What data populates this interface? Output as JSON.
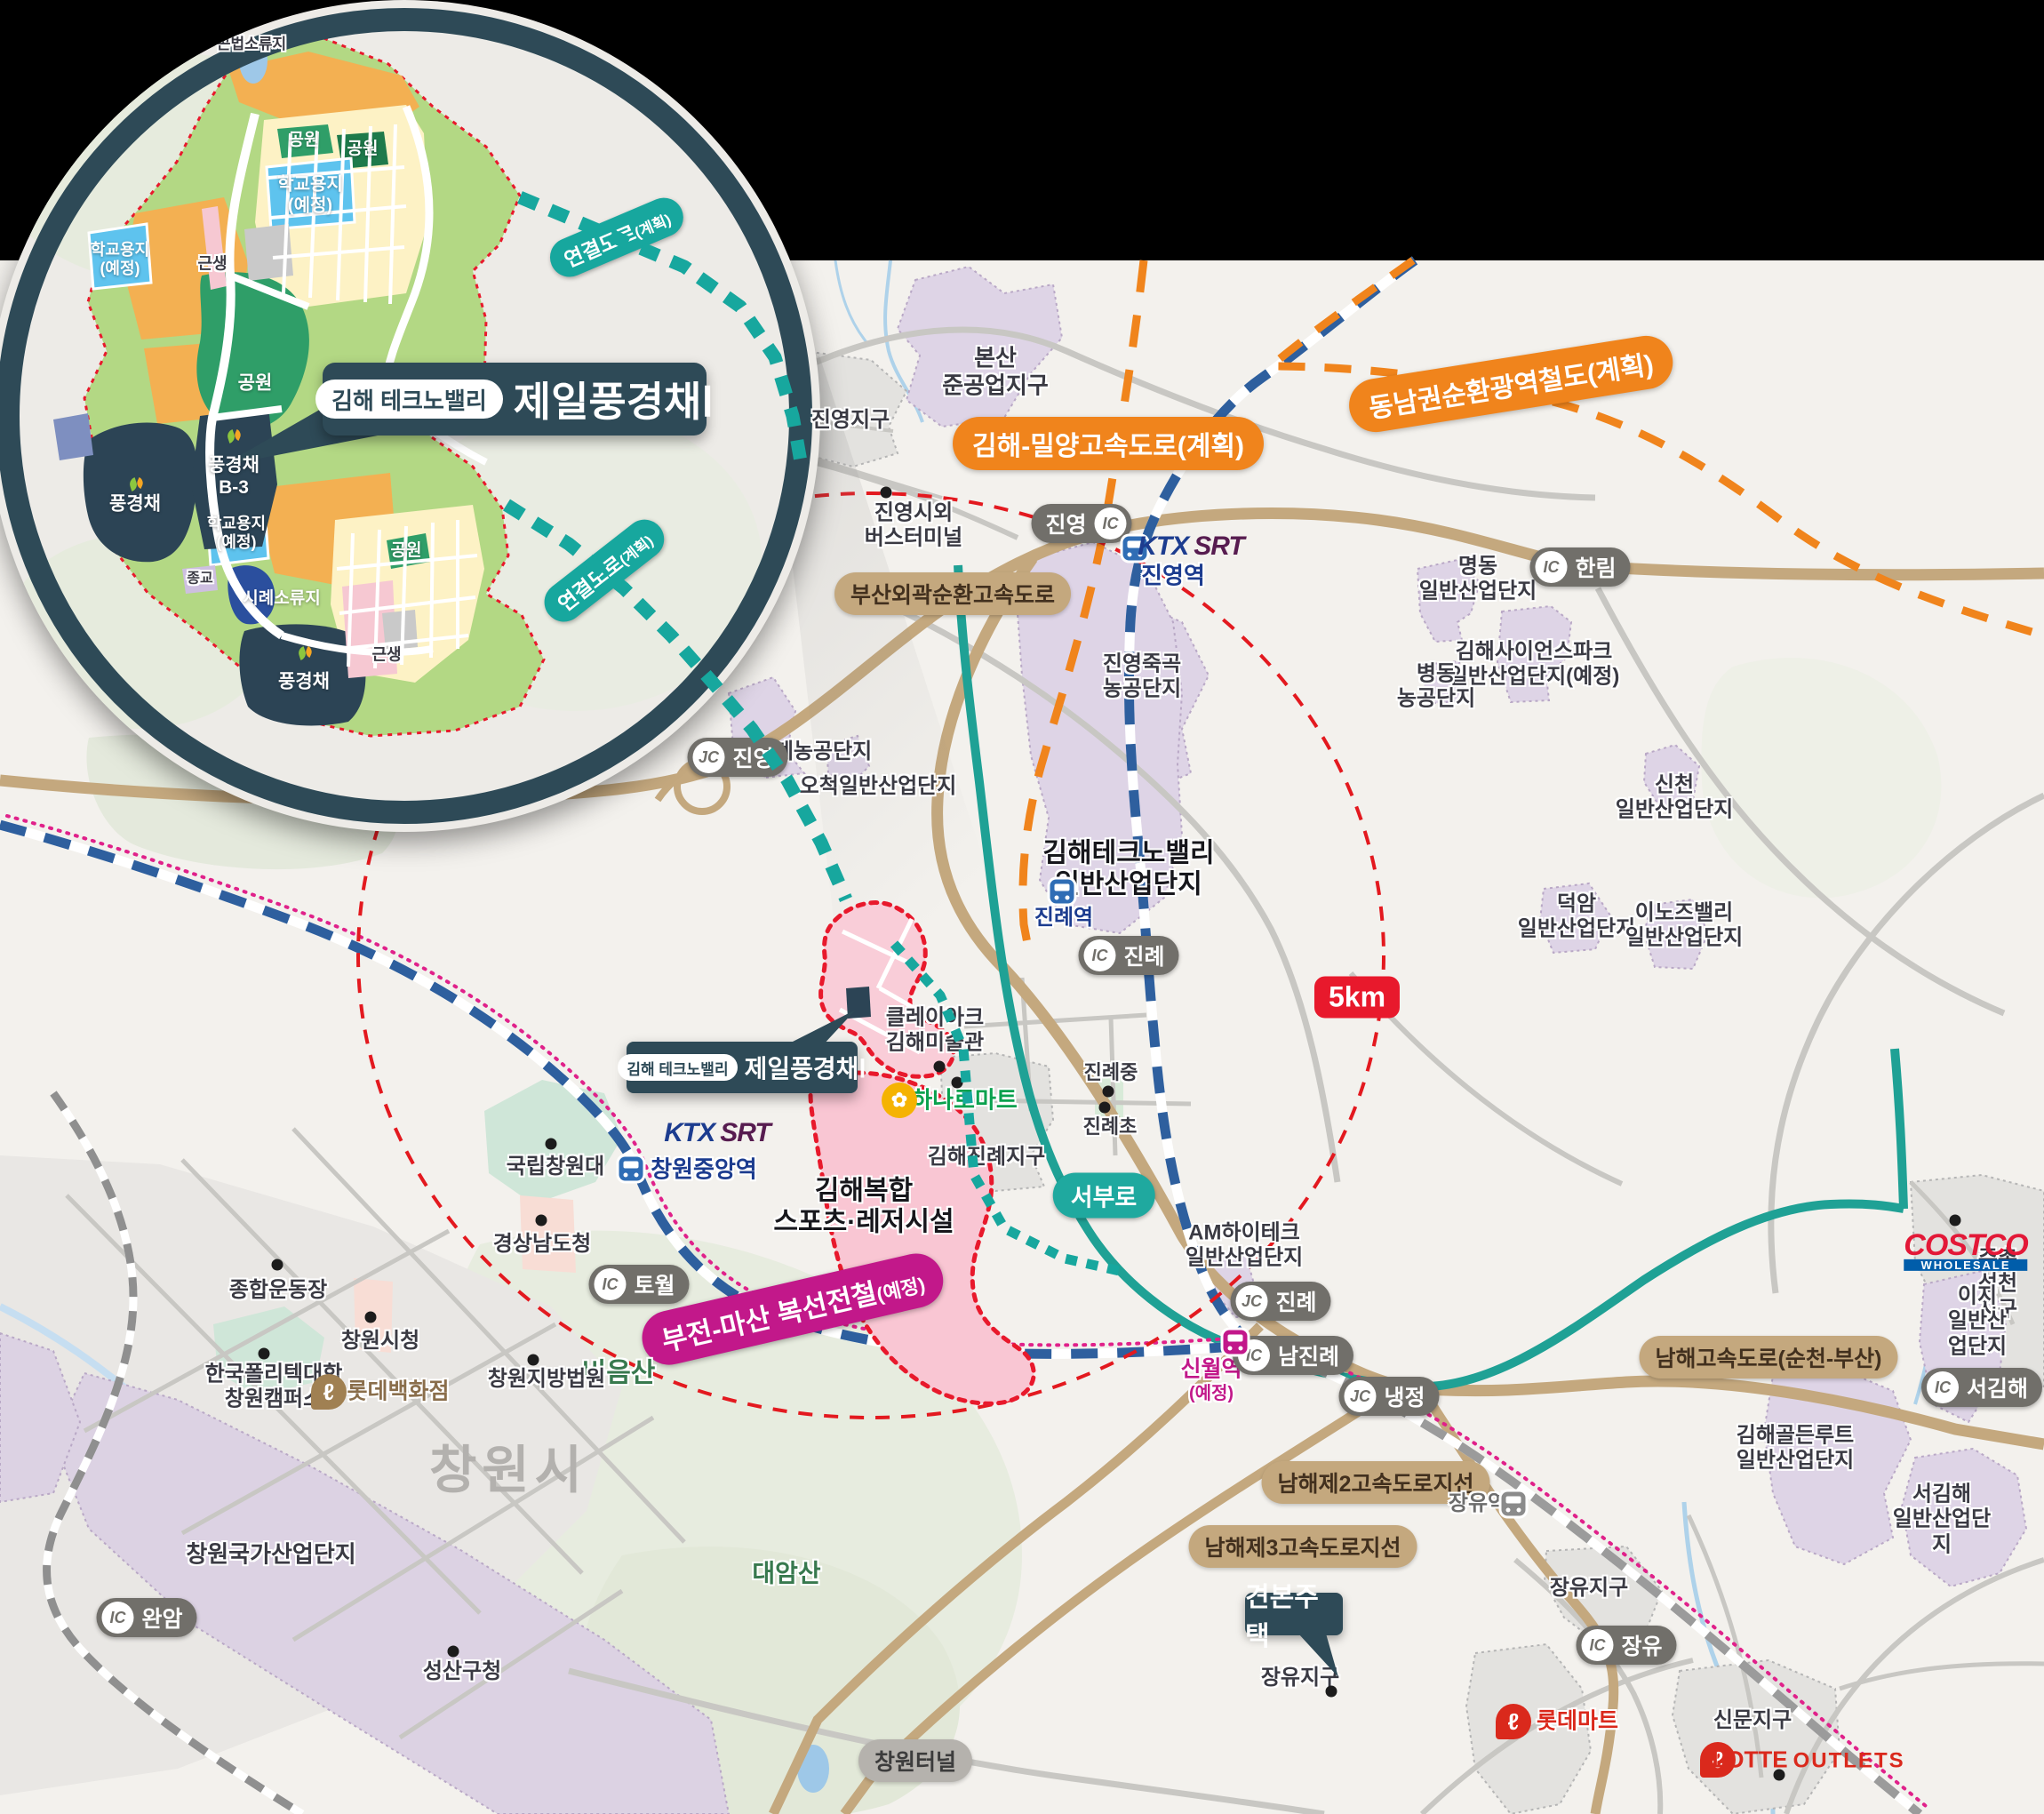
{
  "colors": {
    "navy": "#2e4a57",
    "teal": "#18a49c",
    "orange": "#f0841c",
    "tan": "#c4a87e",
    "magenta": "#c2188a",
    "red": "#e8192c",
    "rail_blue": "#2e5f9e",
    "industrial_purple": "#ded4e6",
    "site_pink": "#f9c9d5"
  },
  "inset": {
    "callout": {
      "badge": "김해 테크노밸리",
      "title": "제일풍경채Ⅰ"
    },
    "labels": {
      "pond_top": "곤법소류지",
      "park": "공원",
      "school": "학교용지\n(예정)",
      "geunsaeng": "근생",
      "pungkyungchae": "풍경채",
      "pungkyungchae_b3": "풍경채\nB-3",
      "religion": "종교",
      "pond_mid": "시례소류지"
    }
  },
  "map": {
    "callout": {
      "badge": "김해 테크노밸리",
      "title": "제일풍경채Ⅰ"
    },
    "sample_house": "견본주택",
    "scale_badge": "5km",
    "road_badges": {
      "connector": "연결도로",
      "connector_note": "(계획)",
      "gimhae_miryang": "김해-밀양고속도로(계획)",
      "dongnam_rail": "동남권순환광역철도(계획)",
      "busan_outer_ring": "부산외곽순환고속도로",
      "namhae_expwy": "남해고속도로(순천-부산)",
      "namhae_branch2": "남해제2고속도로지선",
      "namhae_branch3": "남해제3고속도로지선",
      "bujeon_masan": "부전-마산 복선전철",
      "bujeon_masan_note": "(예정)",
      "seoburo": "서부로",
      "tunnel": "창원터널"
    },
    "interchanges": {
      "jinyeong_ic": {
        "type": "IC",
        "name": "진영"
      },
      "hallim": {
        "type": "IC",
        "name": "한림"
      },
      "jinyeong_jc": {
        "type": "JC",
        "name": "진영"
      },
      "jinrye_ic": {
        "type": "IC",
        "name": "진례"
      },
      "jinrye_jc": {
        "type": "JC",
        "name": "진례"
      },
      "namjinrye": {
        "type": "IC",
        "name": "남진례"
      },
      "naengjeong": {
        "type": "JC",
        "name": "냉정"
      },
      "seogimhae": {
        "type": "IC",
        "name": "서김해"
      },
      "towol": {
        "type": "IC",
        "name": "토월"
      },
      "wanam": {
        "type": "IC",
        "name": "완암"
      },
      "jangyu_ic": {
        "type": "IC",
        "name": "장유"
      }
    },
    "stations": {
      "jinyeong": {
        "brand_ktx": "KTX",
        "brand_srt": "SRT",
        "name": "진영역"
      },
      "changwon_central": {
        "brand_ktx": "KTX",
        "brand_srt": "SRT",
        "name": "창원중앙역"
      },
      "jinrye": {
        "name": "진례역"
      },
      "sinwol": {
        "name": "신월역",
        "note": "(예정)"
      },
      "jangyu": {
        "name": "장유역"
      }
    },
    "area_labels": {
      "bonsan": "본산\n준공업지구",
      "jinyeong_district": "진영지구",
      "jukgok": "진영죽곡\n농공단지",
      "myeongdong": "명동\n일반산업단지",
      "science_park": "김해사이언스파크\n일반산업단지(예정)",
      "byeongdong": "병동\n농공단지",
      "sincheon": "신천\n일반산업단지",
      "deogam": "덕암\n일반산업단지",
      "innoz_valley": "이노즈밸리\n일반산업단지",
      "hagye": "하계농공단지",
      "ocheok": "오척일반산업단지",
      "technovalley": "김해테크노밸리\n일반산업단지",
      "gimhae_jinrye": "김해진례지구",
      "am_hightech": "AM하이테크\n일반산업단지",
      "juchon": "주촌선천지구",
      "iji": "이지\n일반산업단지",
      "golden_route": "김해골든루트\n일반산업단지",
      "seogimhae_ind": "서김해\n일반산업단지",
      "jangyu_district": "장유지구",
      "sinmun": "신문지구",
      "changwon_city": "창원시",
      "changwon_national": "창원국가산업단지",
      "sports_complex": "김해복합\n스포츠·레저시설",
      "bieumsan": "비음산",
      "daeamsan": "대암산"
    },
    "poi_labels": {
      "terminal": "진영시외\n버스터미널",
      "clayarch": "클레이아크\n김해미술관",
      "jinryejung": "진례중",
      "jinryecho": "진례초",
      "kungnip": "국립창원대",
      "gyeongnam": "경상남도청",
      "jonghap": "종합운동장",
      "sicheong": "창원시청",
      "polytech": "한국폴리텍대학\n창원캠퍼스",
      "court": "창원지방법원",
      "seongsan": "성산구청"
    },
    "brand": {
      "costco": "COSTCO",
      "costco_sub": "WHOLESALE",
      "hanaro": "하나로마트",
      "lotte_dept": "롯데백화점",
      "lotte_mart": "롯데마트",
      "lotte_outlets_1": "LOTTE",
      "lotte_outlets_2": "OUTLETS"
    }
  }
}
